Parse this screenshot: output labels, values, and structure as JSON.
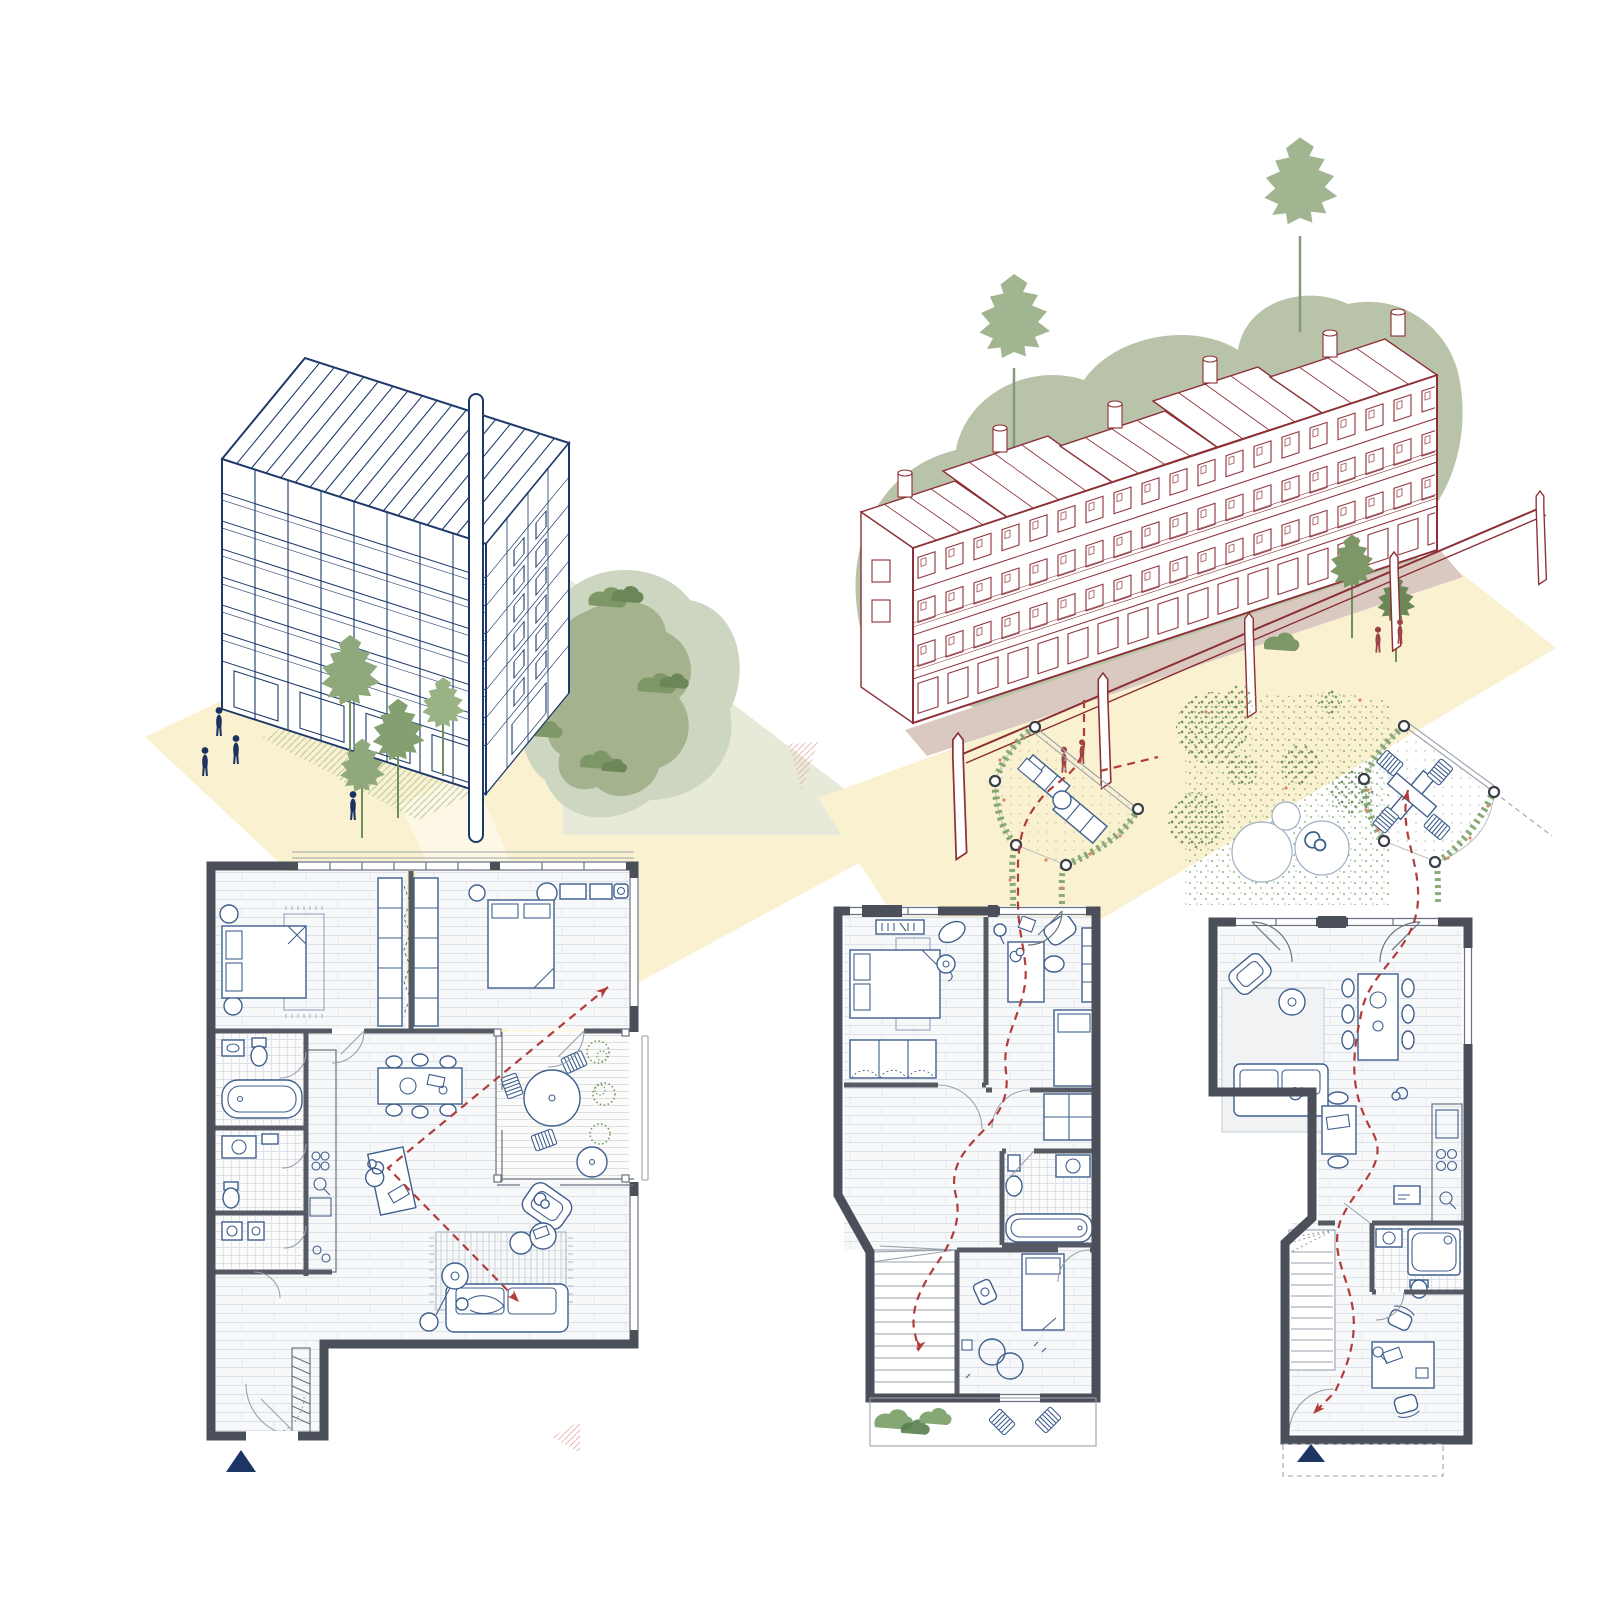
{
  "sheet": {
    "background": "#ffffff",
    "width": 1600,
    "height": 1600,
    "description": "architectural-drawing-sheet"
  },
  "colors": {
    "blue_line": "#1d3a6a",
    "furniture_blue": "#3f5f8d",
    "wall_grey": "#4a4f59",
    "partition_grey": "#555a64",
    "thin_grey": "#6b7280",
    "light_grey": "#9aa2ad",
    "floor_line": "#dee1e5",
    "red_line": "#8c2f36",
    "dash_red": "#b23c3c",
    "person_navy": "#1c3260",
    "person_red": "#9e4448",
    "north_navy": "#1d3564",
    "cream": "#faf1d1",
    "mauve": "#dac9c1",
    "sage_blob": "#b8c3a9",
    "lawn_halo": "#cdd6c1",
    "lawn_green": "#a4b28d",
    "bush_green": "#7d9766",
    "bush_dark": "#6b8758",
    "tree_green": "#90a97c",
    "tree_light": "#a2b591",
    "trunk": "#6f8f60",
    "stipple_green": "#7da26b",
    "stipple_dark": "#587e4b",
    "flower_orange": "#e08560",
    "pink_hatch": "#e7aba2",
    "deck_dot": "#c2c8c1",
    "pale_sage": "#e7ead9"
  },
  "panels": {
    "iso_blue": {
      "name": "isometric-apartment-tower"
    },
    "iso_red": {
      "name": "isometric-terrace-block-with-viaduct"
    },
    "plan_flat": {
      "name": "two-bed-apartment-floor-plan"
    },
    "plan_maisonette_a": {
      "name": "maisonette-plan-with-roof-terrace"
    },
    "plan_maisonette_b": {
      "name": "maisonette-plan-with-garden"
    }
  },
  "symbols": {
    "north_arrow": "north-arrow-icon",
    "route": "dashed-route-arrow",
    "person": "person-figure",
    "tree": "tree-icon",
    "bush": "bush-icon"
  }
}
